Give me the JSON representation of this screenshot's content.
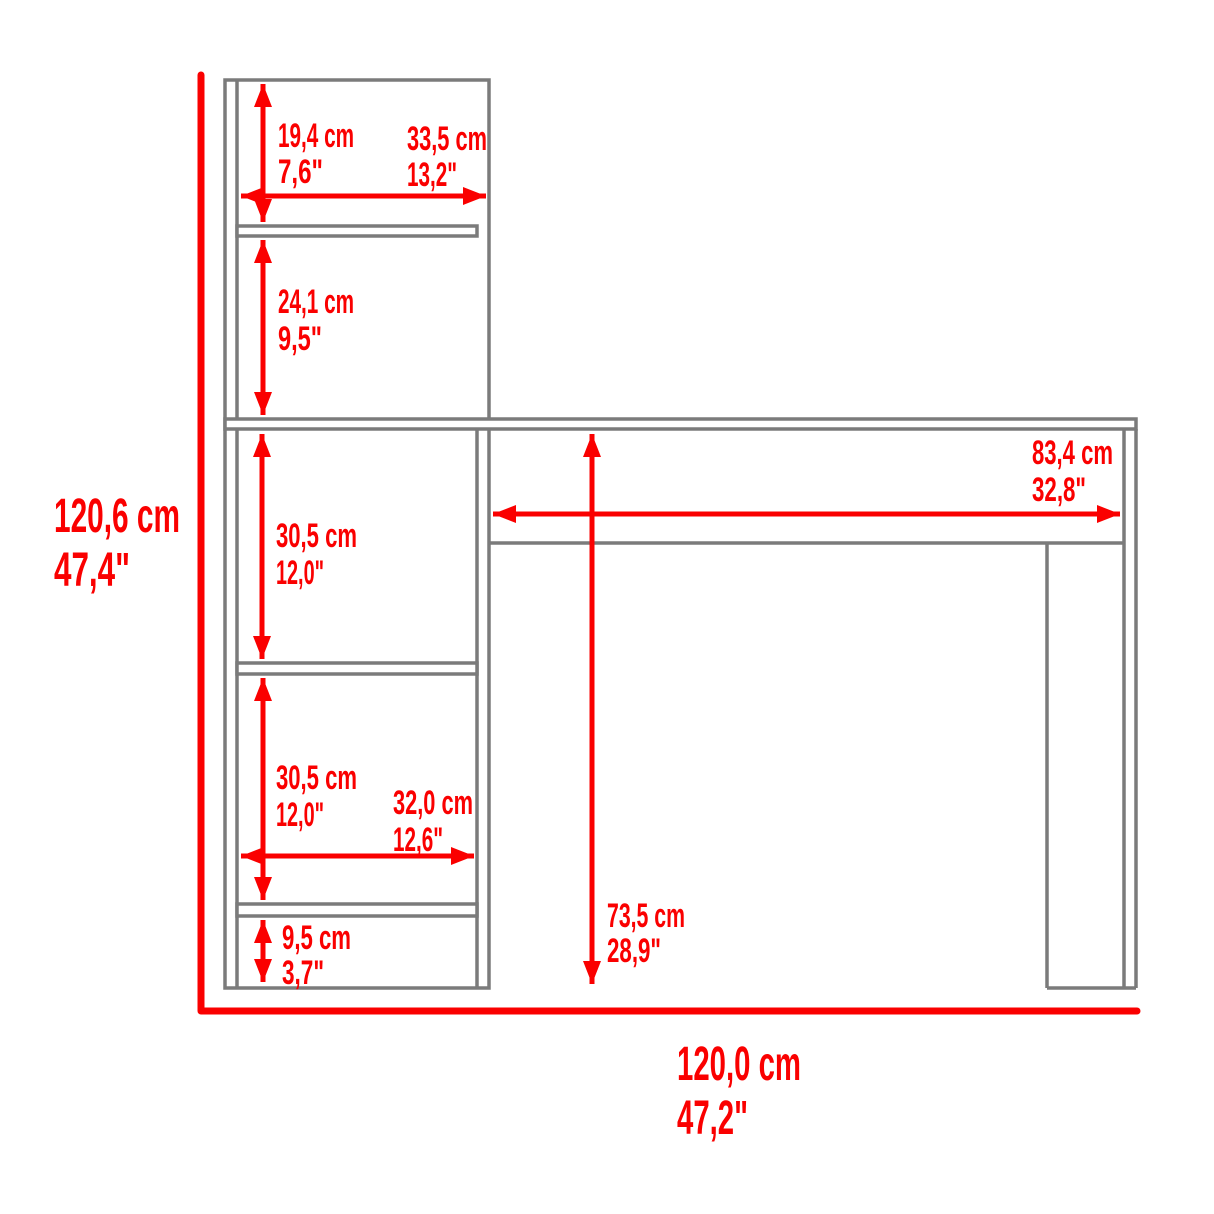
{
  "colors": {
    "accent": "#fa0000",
    "outline": "#7b7b7b",
    "background": "#ffffff"
  },
  "diagram_type": "desk-with-bookcase-dimension-drawing",
  "overall": {
    "height": {
      "cm": "120,6 cm",
      "inches": "47,4\""
    },
    "width": {
      "cm": "120,0 cm",
      "inches": "47,2\""
    }
  },
  "dimensions": {
    "hutch_top_height": {
      "cm": "19,4 cm",
      "inches": "7,6\""
    },
    "hutch_shelf_width": {
      "cm": "33,5 cm",
      "inches": "13,2\""
    },
    "hutch_lower_height": {
      "cm": "24,1 cm",
      "inches": "9,5\""
    },
    "shelf_opening_upper_height": {
      "cm": "30,5 cm",
      "inches": "12,0\""
    },
    "desktop_clear_width": {
      "cm": "83,4 cm",
      "inches": "32,8\""
    },
    "shelf_opening_lower_height": {
      "cm": "30,5 cm",
      "inches": "12,0\""
    },
    "shelf_opening_width": {
      "cm": "32,0 cm",
      "inches": "12,6\""
    },
    "base_opening_height": {
      "cm": "9,5 cm",
      "inches": "3,7\""
    },
    "desk_underside_height": {
      "cm": "73,5 cm",
      "inches": "28,9\""
    }
  }
}
